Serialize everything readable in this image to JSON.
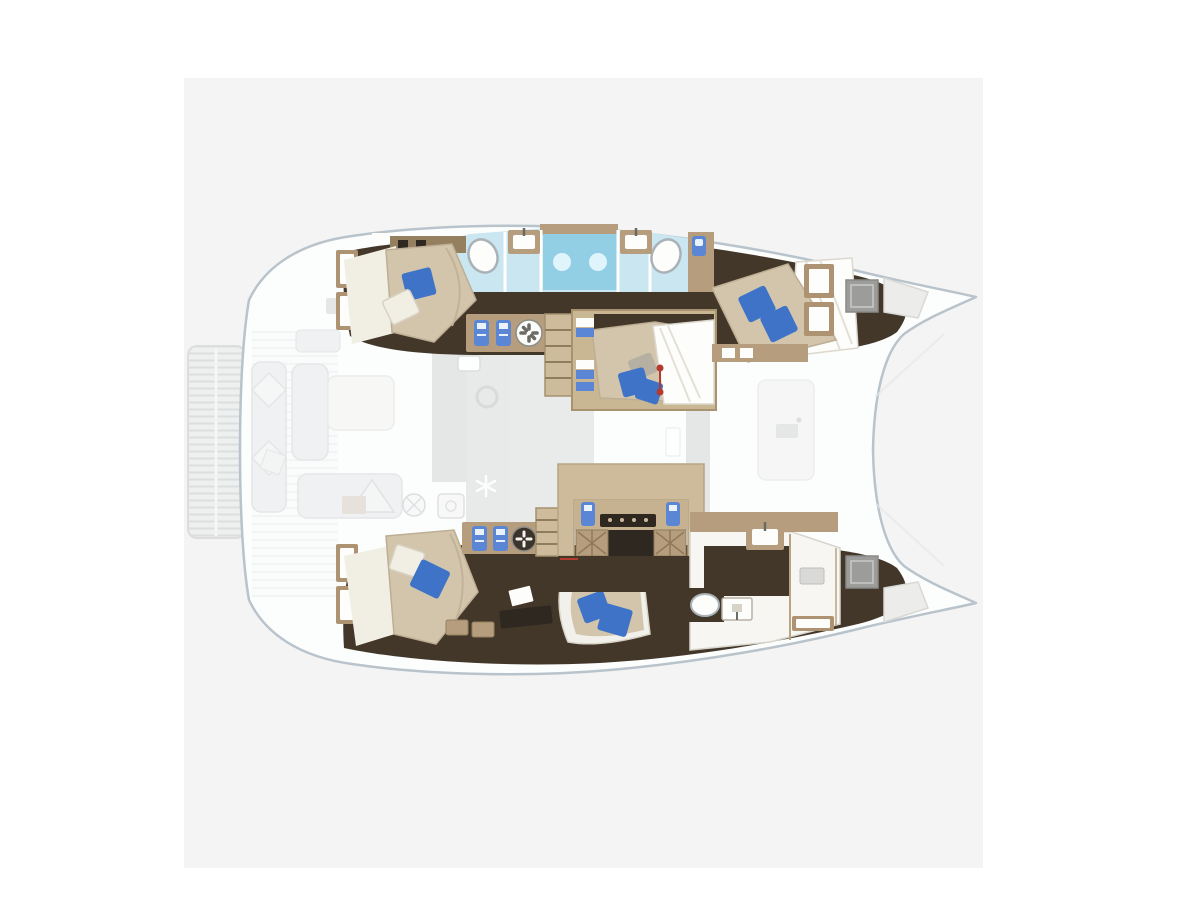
{
  "palette": {
    "page_bg": "#ffffff",
    "card_bg": "#f4f4f4",
    "hull_fill": "#fcfdfd",
    "hull_stroke": "#b9c3cb",
    "ghost_fill": "#e9eaeb",
    "ghost_stroke": "#d5d8d9",
    "ghost_dark": "#d7d9d9",
    "ghost_floor": "#dcdddd",
    "floor_dark": "#43372a",
    "floor_dark2": "#2f2821",
    "wood": "#b59d7d",
    "wood_light": "#cdbb9b",
    "wood_dark": "#94805f",
    "mattress": "#d2c5ac",
    "sheet_white": "#f1eee4",
    "pillow_blue": "#3f73c8",
    "pillow_gray": "#b6b0a2",
    "bath_floor": "#c9e6f1",
    "shower_blue": "#92cfe5",
    "shower_glow": "#e8f8fd",
    "white_floor": "#f7f6f3",
    "hatch_gray": "#9c9c9a",
    "window_frame": "#ad9372",
    "window_glass": "#fdfdfc",
    "bottle_blue": "#5b86d5",
    "marker_red": "#b23a2e"
  },
  "scene": {
    "type": "yacht-floor-plan",
    "vessel_type": "catamaran",
    "view": "overhead-deck-plan",
    "ghosted_upper_deck": [
      "stern-swim-platform",
      "cockpit-bench",
      "cockpit-cushions",
      "saloon-table",
      "saloon-sofa",
      "galley-counter",
      "galley-sink-icon",
      "galley-stove-icon",
      "kettle-icon",
      "snowflake-icon",
      "chart-table",
      "foredeck"
    ],
    "lower_deck": {
      "port_hull": [
        "aft-cabin-double-bed",
        "hull-windows",
        "en-suite-bathroom",
        "twin-showers",
        "twin-washbasins",
        "oval-sinks",
        "toilet",
        "wardrobe-hangers",
        "fan-wheel-icon",
        "companionway-stairs",
        "corridor"
      ],
      "center": [
        "mid-cabin-double-bed",
        "bed-dimension-marker",
        "galley-unit",
        "stove",
        "bottle-icons",
        "wicker-locker-doors"
      ],
      "starboard_hull": [
        "aft-cabin-double-bed",
        "hull-windows",
        "wardrobe-hangers",
        "fan-wheel-icon",
        "companionway-stairs",
        "desk",
        "sofa-seat",
        "bathroom",
        "washbasins",
        "toilet",
        "shower-stall",
        "corridor"
      ]
    },
    "bow_features": [
      "deck-hatch-port",
      "anchor-locker-port",
      "deck-hatch-starboard",
      "anchor-locker-starboard"
    ]
  }
}
